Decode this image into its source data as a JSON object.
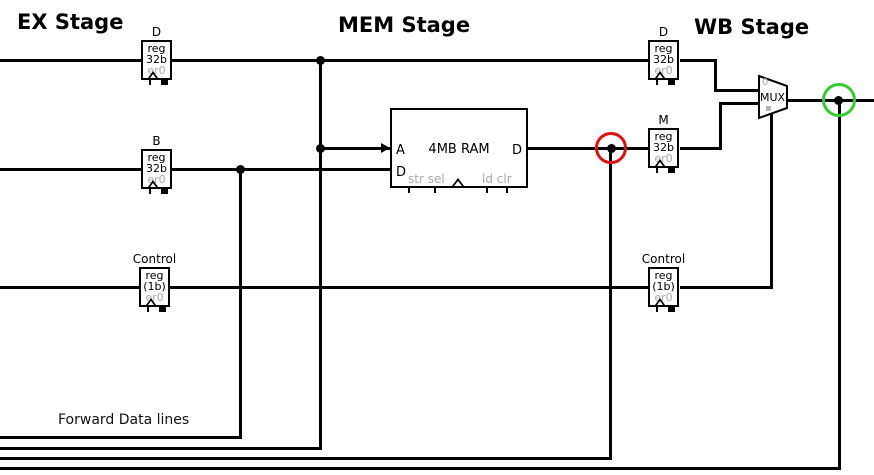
{
  "titles": {
    "ex": "EX Stage",
    "mem": "MEM Stage",
    "wb": "WB Stage"
  },
  "registers": [
    {
      "stage": "EX",
      "label": "D",
      "line1": "reg",
      "line2": "32b",
      "value": "er0"
    },
    {
      "stage": "EX",
      "label": "B",
      "line1": "reg",
      "line2": "32b",
      "value": "er0"
    },
    {
      "stage": "EX",
      "label": "Control",
      "line1": "reg",
      "line2": "(1b)",
      "value": "er0"
    },
    {
      "stage": "WB",
      "label": "D",
      "line1": "reg",
      "line2": "32b",
      "value": "er0"
    },
    {
      "stage": "WB",
      "label": "M",
      "line1": "reg",
      "line2": "32b",
      "value": "er0"
    },
    {
      "stage": "WB",
      "label": "Control",
      "line1": "reg",
      "line2": "(1b)",
      "value": "er0"
    }
  ],
  "ram": {
    "name": "4MB RAM",
    "port_a": "A",
    "port_d_in": "D",
    "port_d_out": "D",
    "ctrl_left": "str sel",
    "ctrl_right": "ld clr"
  },
  "mux": {
    "label": "MUX",
    "port0": "0"
  },
  "annotations": {
    "forward_label": "Forward Data lines",
    "red_circle_color": "#e01010",
    "green_circle_color": "#33cc33"
  },
  "colors": {
    "wire": "#000000",
    "muted_text": "#a9a9a9"
  }
}
